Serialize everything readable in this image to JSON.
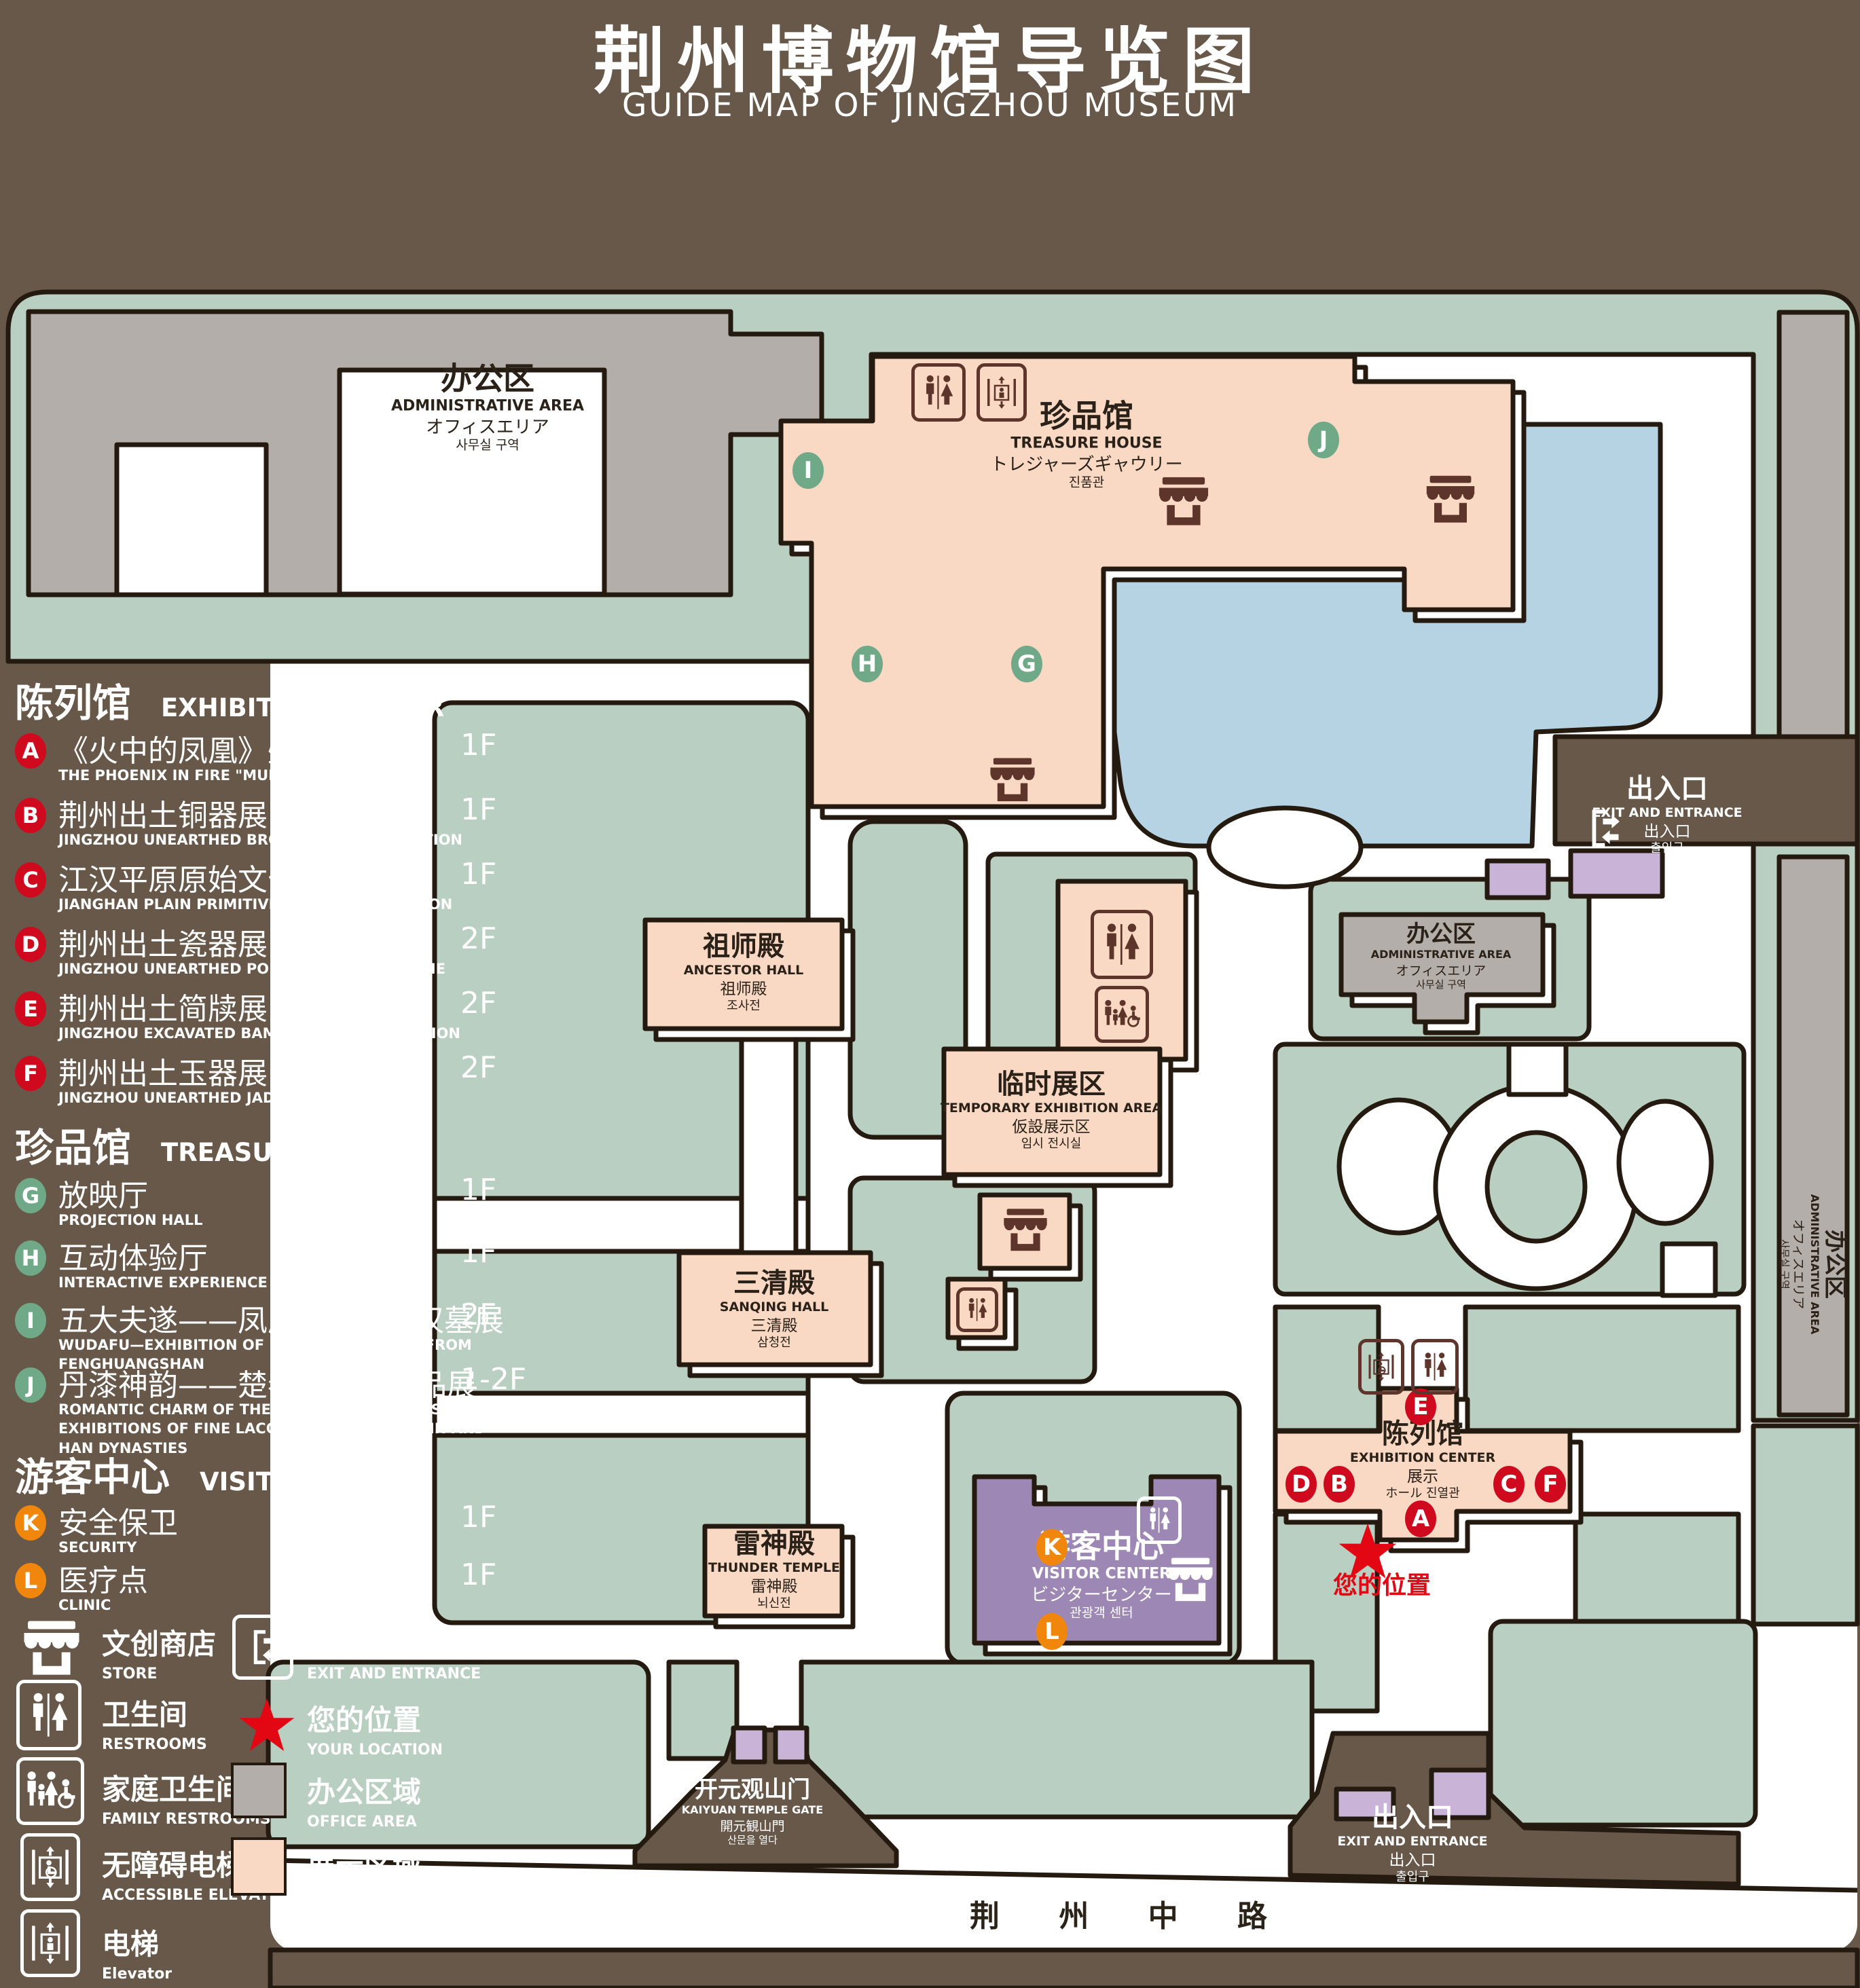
{
  "title": {
    "zh": "荆州博物馆导览图",
    "en": "GUIDE MAP OF JINGZHOU MUSEUM"
  },
  "colors": {
    "background": "#67584a",
    "lawn": "#b9cfc1",
    "display_area": "#f9d8c4",
    "office_area": "#b4aeab",
    "pond": "#b5d3e2",
    "visitor_center": "#9d87b5",
    "purple_light": "#c9b4d8",
    "marker_red": "#cf0a1e",
    "marker_green": "#6fa987",
    "marker_orange": "#f0860b",
    "icon_maroon": "#5e352b",
    "location_red": "#e30613",
    "outline": "#241a10"
  },
  "legend": {
    "sections": [
      {
        "id": "exhibition",
        "zh": "陈列馆",
        "en": "EXHIBITION CENTER",
        "items": [
          {
            "letter": "A",
            "zh": "《火中的凤凰》壁画",
            "en": "THE PHOENIX IN FIRE \"MURAL PAINTING",
            "floor": "1F"
          },
          {
            "letter": "B",
            "zh": "荆州出土铜器展",
            "en": "JINGZHOU UNEARTHED BRONZE WARE EXHIBITION",
            "floor": "1F"
          },
          {
            "letter": "C",
            "zh": "江汉平原原始文化展",
            "en": "JIANGHAN PLAIN PRIMITIVE CULTURE EXHIBITION",
            "floor": "1F"
          },
          {
            "letter": "D",
            "zh": "荆州出土瓷器展",
            "en": "JINGZHOU UNEARTHED PORCELAIN EXHIBITIONE",
            "floor": "2F"
          },
          {
            "letter": "E",
            "zh": "荆州出土简牍展",
            "en": "JINGZHOU EXCAVATED BAMBOO SLIPS EXHIBITION",
            "floor": "2F"
          },
          {
            "letter": "F",
            "zh": "荆州出土玉器展",
            "en": "JINGZHOU UNEARTHED JADE EXHIBITION",
            "floor": "2F"
          }
        ]
      },
      {
        "id": "treasure",
        "zh": "珍品馆",
        "en": "TREASURE HOUSE",
        "items": [
          {
            "letter": "G",
            "zh": "放映厅",
            "en": "PROJECTION HALL",
            "floor": "1F"
          },
          {
            "letter": "H",
            "zh": "互动体验厅",
            "en": "INTERACTIVE EXPERIENCE HALL",
            "floor": "1F"
          },
          {
            "letter": "I",
            "zh": "五大夫遂——凤凰山168号汉墓展",
            "en": "WUDAFU—EXHIBITION OF NO.168 HAN TOMB FROM FENGHUANGSHAN",
            "floor": "2F"
          },
          {
            "letter": "J",
            "zh": "丹漆神韵——楚秦汉漆器精品展",
            "en": "ROMANTIC CHARM OF THE CRIMSON LACQUERS—EXHIBITIONS OF FINE LACQUERS FROM CHU,QIN AND HAN DYNASTIES",
            "floor": "1-2F"
          }
        ]
      },
      {
        "id": "visitor",
        "zh": "游客中心",
        "en": "VISITOR CENTER",
        "items": [
          {
            "letter": "K",
            "zh": "安全保卫",
            "en": "SECURITY",
            "floor": "1F"
          },
          {
            "letter": "L",
            "zh": "医疗点",
            "en": "CLINIC",
            "floor": "1F"
          }
        ]
      }
    ],
    "symbols": [
      {
        "icon": "store-icon",
        "zh": "文创商店",
        "en": "STORE"
      },
      {
        "icon": "exit-icon",
        "zh": "出入口",
        "en": "EXIT AND ENTRANCE"
      },
      {
        "icon": "restroom-icon",
        "zh": "卫生间",
        "en": "RESTROOMS"
      },
      {
        "icon": "location-star-icon",
        "zh": "您的位置",
        "en": "YOUR LOCATION"
      },
      {
        "icon": "family-restroom-icon",
        "zh": "家庭卫生间",
        "en": "FAMILY RESTROOMS"
      },
      {
        "icon": "office-area-swatch",
        "zh": "办公区域",
        "en": "OFFICE AREA"
      },
      {
        "icon": "accessible-elevator-icon",
        "zh": "无障碍电梯",
        "en": "ACCESSIBLE ELEVATOR"
      },
      {
        "icon": "display-area-swatch",
        "zh": "展示区域",
        "en": "DISPLAY AREA"
      },
      {
        "icon": "elevator-icon",
        "zh": "电梯",
        "en": "Elevator"
      }
    ]
  },
  "map": {
    "buildings": {
      "admin_tl": {
        "zh": "办公区",
        "en": "ADMINISTRATIVE AREA",
        "ja": "オフィスエリア",
        "ko": "사무실 구역"
      },
      "admin_right": {
        "zh": "办公区",
        "en": "ADMINISTRATIVE AREA",
        "ja": "オフィスエリア",
        "ko": "사무실 구역"
      },
      "admin_strip": {
        "zh": "办公区",
        "en": "ADMINISTRATIVE AREA",
        "ja": "オフィスエリア",
        "ko": "사무실 구역"
      },
      "treasure_house": {
        "zh": "珍品馆",
        "en": "TREASURE HOUSE",
        "ja": "トレジャーズギャウリー",
        "ko": "진품관"
      },
      "ancestor_hall": {
        "zh": "祖师殿",
        "en": "ANCESTOR HALL",
        "ja": "祖师殿",
        "ko": "조사전"
      },
      "temporary_exhibition": {
        "zh": "临时展区",
        "en": "TEMPORARY EXHIBITION AREA",
        "ja": "仮設展示区",
        "ko": "임시 전시실"
      },
      "sanqing_hall": {
        "zh": "三清殿",
        "en": "SANQING HALL",
        "ja": "三清殿",
        "ko": "삼청전"
      },
      "thunder_temple": {
        "zh": "雷神殿",
        "en": "THUNDER TEMPLE",
        "ja": "雷神殿",
        "ko": "뇌신전"
      },
      "visitor_center": {
        "zh": "游客中心",
        "en": "VISITOR CENTER",
        "ja": "ビジターセンター",
        "ko": "관광객 센터"
      },
      "exhibition_center": {
        "zh": "陈列馆",
        "en": "EXHIBITION CENTER",
        "ja": "展示",
        "ko": "ホール 진열관"
      },
      "kaiyuan_gate": {
        "zh": "开元观山门",
        "en": "KAIYUAN TEMPLE GATE",
        "ja": "開元観山門",
        "ko": "산문을 열다"
      },
      "exit_right": {
        "zh": "出入口",
        "en": "EXIT AND ENTRANCE",
        "ja": "出入口",
        "ko": "출입구"
      },
      "exit_bottom": {
        "zh": "出入口",
        "en": "EXIT AND ENTRANCE",
        "ja": "出入口",
        "ko": "출입구"
      }
    },
    "road": "荆 州 中 路",
    "your_location": "您的位置",
    "markers": {
      "A": "A",
      "B": "B",
      "C": "C",
      "D": "D",
      "E": "E",
      "F": "F",
      "G": "G",
      "H": "H",
      "I": "I",
      "J": "J",
      "K": "K",
      "L": "L"
    }
  }
}
